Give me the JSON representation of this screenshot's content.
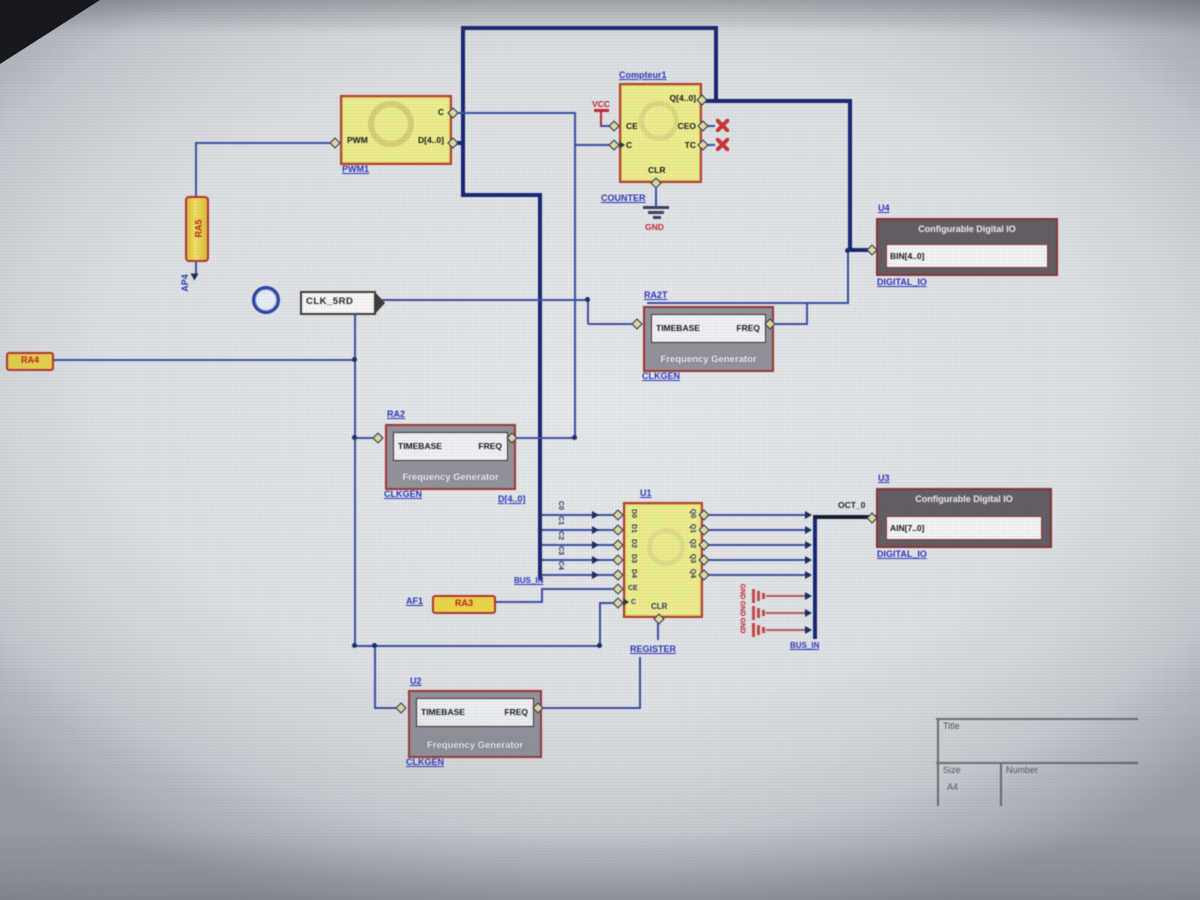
{
  "counter": {
    "title": "Compteur1",
    "q": "Q[4..0]",
    "ce": "CE",
    "c": "C",
    "ceo": "CEO",
    "tc": "TC",
    "clr": "CLR",
    "label": "COUNTER",
    "vcc": "VCC",
    "gnd": "GND"
  },
  "pwm": {
    "ref": "PWM1",
    "c": "C",
    "pwm": "PWM",
    "d": "D[4..0]"
  },
  "reg": {
    "ref": "U1",
    "dpins": [
      "D0",
      "D1",
      "D2",
      "D3",
      "D4"
    ],
    "qpins": [
      "Q0",
      "Q1",
      "Q2",
      "Q3",
      "Q4"
    ],
    "ce": "CE",
    "c": "C",
    "clr": "CLR",
    "label": "REGISTER"
  },
  "fg": {
    "timebase": "TIMEBASE",
    "freq": "FREQ",
    "body": "Frequency Generator",
    "clkgen": "CLKGEN"
  },
  "fg_refs": {
    "ra2t": "RA2T",
    "ra2": "RA2",
    "u2": "U2"
  },
  "dio": {
    "title": "Configurable Digital IO",
    "label": "DIGITAL_IO",
    "u4": "U4",
    "u3": "U3",
    "bin": "BIN[4..0]",
    "ain": "AIN[7..0]",
    "oct": "OCT_0"
  },
  "tags": {
    "ra4": "RA4",
    "ra3": "RA3",
    "af1": "AF1",
    "clk": "CLK_5RD",
    "ra5": "RA5",
    "ap4": "AP4"
  },
  "nets": {
    "dbus": "D[4..0]",
    "busin_l": "BUS_IN",
    "busin_r": "BUS_IN",
    "taps": [
      "C0",
      "C1",
      "C2",
      "C3",
      "C4"
    ],
    "gnds": [
      "GND",
      "GND",
      "GND"
    ]
  },
  "titleblock": {
    "title": "Title",
    "size": "Size",
    "size_value": "A4",
    "number": "Number"
  },
  "colors": {
    "wire": "#3c4da0",
    "bus": "#16246e",
    "block_fill": "#ecec8e",
    "block_border": "#b03a28",
    "net_label": "#2b35b5",
    "alert": "#bb2233"
  }
}
